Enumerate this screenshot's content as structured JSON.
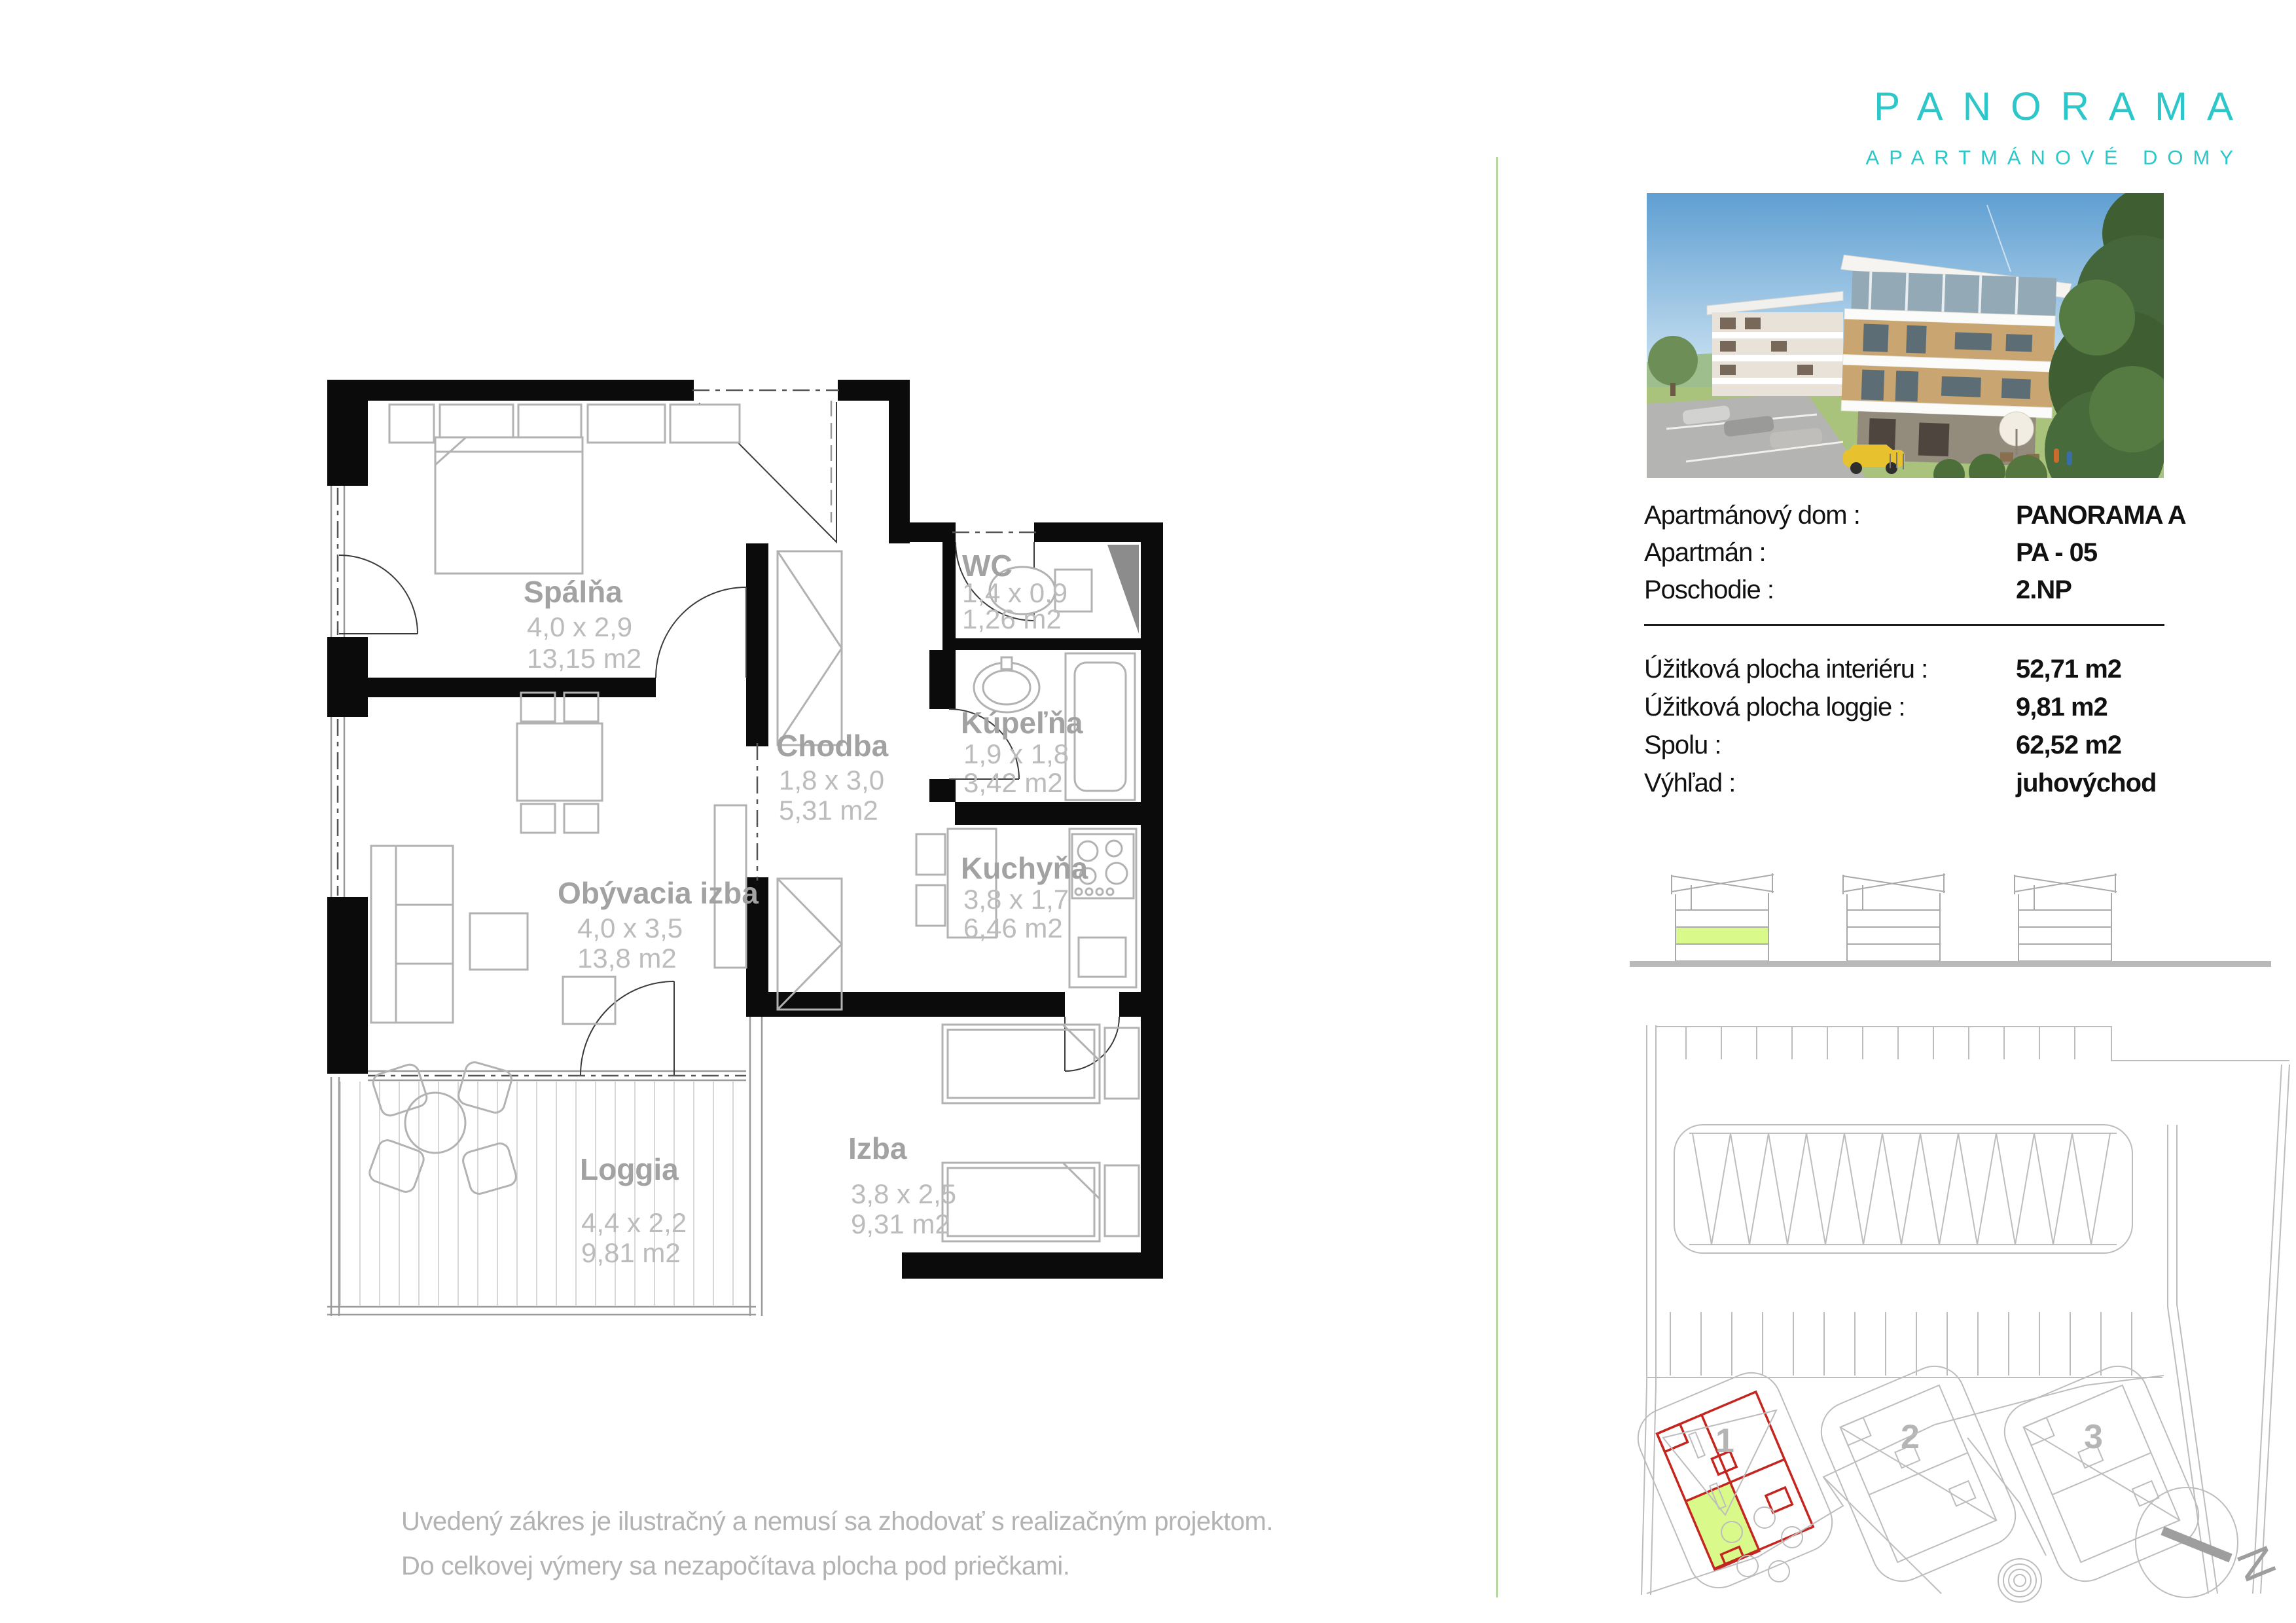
{
  "brand": {
    "name": "PANORAMA",
    "subtitle": "APARTMÁNOVÉ DOMY",
    "color": "#2dc6c9"
  },
  "info": {
    "block1": [
      {
        "label": "Apartmánový dom :",
        "value": "PANORAMA A"
      },
      {
        "label": "Apartmán :",
        "value": "PA - 05"
      },
      {
        "label": "Poschodie :",
        "value": "2.NP"
      }
    ],
    "block2": [
      {
        "label": "Úžitková plocha interiéru :",
        "value": "52,71 m2"
      },
      {
        "label": "Úžitková plocha loggie :",
        "value": "9,81 m2"
      },
      {
        "label": "Spolu :",
        "value": "62,52 m2"
      },
      {
        "label": "Výhľad :",
        "value": "juhovýchod"
      }
    ]
  },
  "floor_plan": {
    "rooms": [
      {
        "name": "Spálňa",
        "dims": "4,0 x 2,9",
        "area": "13,15 m2"
      },
      {
        "name": "WC",
        "dims": "1,4 x 0,9",
        "area": "1,26 m2"
      },
      {
        "name": "Chodba",
        "dims": "1,8 x 3,0",
        "area": "5,31 m2"
      },
      {
        "name": "Kúpeľňa",
        "dims": "1,9 x 1,8",
        "area": "3,42 m2"
      },
      {
        "name": "Kuchyňa",
        "dims": "3,8 x 1,7",
        "area": "6,46 m2"
      },
      {
        "name": "Obývacia izba",
        "dims": "4,0 x 3,5",
        "area": "13,8 m2"
      },
      {
        "name": "Izba",
        "dims": "3,8 x 2,5",
        "area": "9,31 m2"
      },
      {
        "name": "Loggia",
        "dims": "4,4 x 2,2",
        "area": "9,81 m2"
      }
    ]
  },
  "site_plan": {
    "buildings": [
      "1",
      "2",
      "3"
    ],
    "north": "N",
    "highlight_color": "#d9f98b",
    "outline_color": "#c4251f"
  },
  "disclaimer": {
    "line1": "Uvedený zákres je ilustračný a nemusí sa zhodovať s realizačným projektom.",
    "line2": "Do celkovej výmery sa nezapočítava plocha pod priečkami."
  }
}
